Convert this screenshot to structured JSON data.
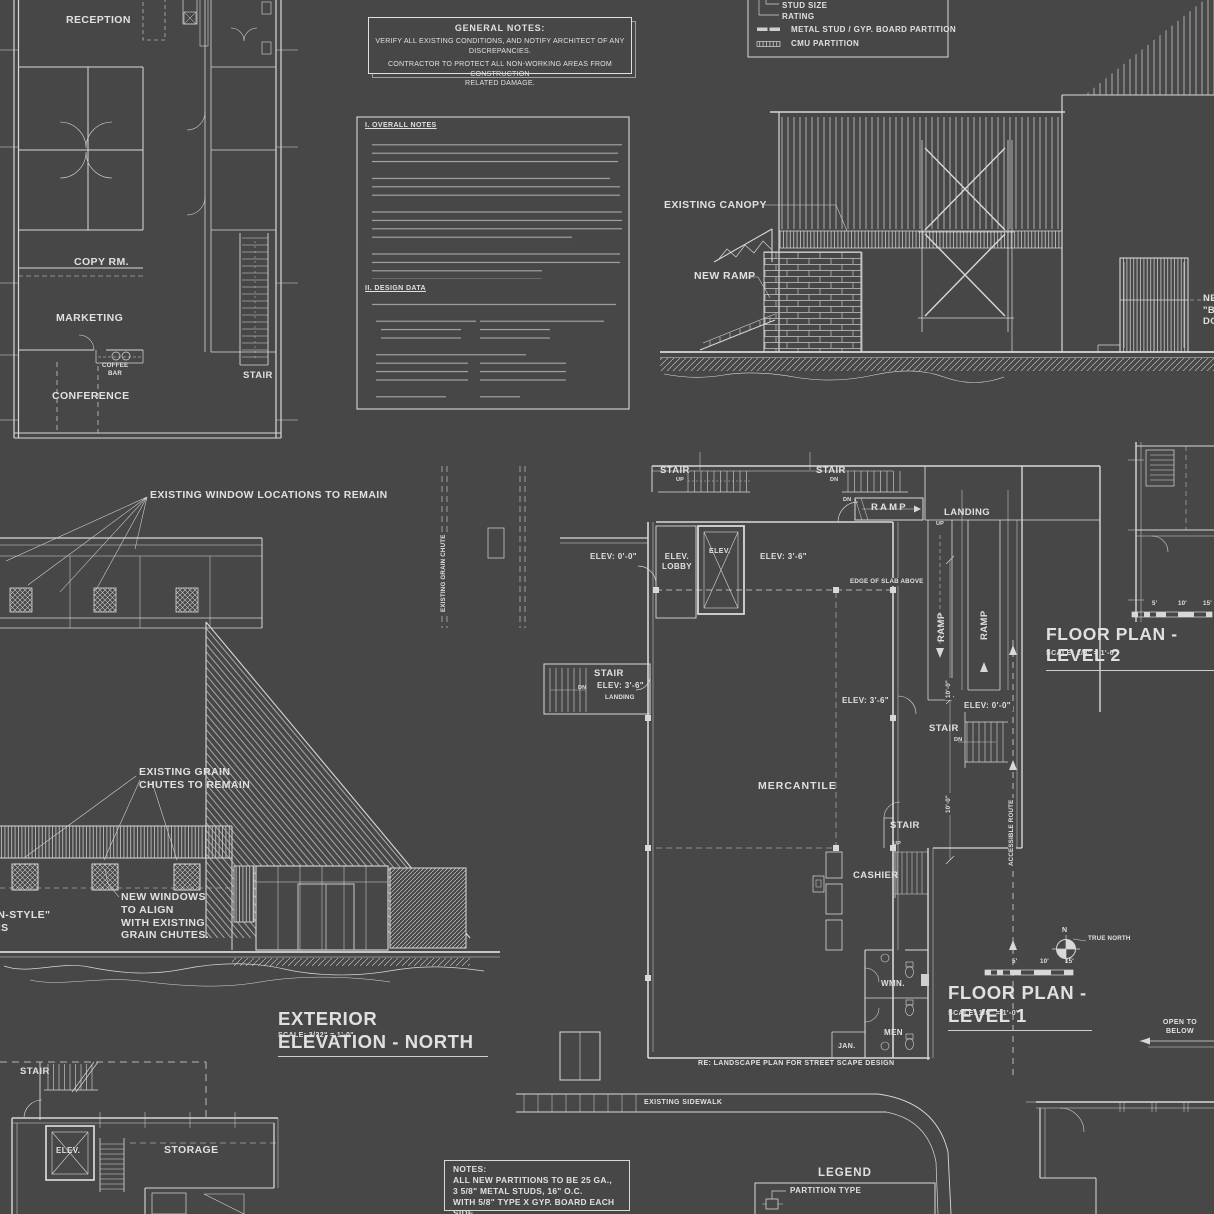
{
  "colors": {
    "background": "#474747",
    "line": "#d8d8d8",
    "text": "#e0e0e0"
  },
  "office_plan": {
    "reception": "RECEPTION",
    "copy_room": "COPY RM.",
    "marketing": "MARKETING",
    "coffee_bar": "COFFEE\nBAR",
    "conference": "CONFERENCE",
    "stair": "STAIR"
  },
  "general_notes": {
    "title": "GENERAL NOTES:",
    "line1": "VERIFY ALL EXISTING CONDITIONS, AND NOTIFY ARCHITECT OF ANY DISCREPANCIES.",
    "line2": "CONTRACTOR TO PROTECT ALL NON-WORKING AREAS FROM CONSTRUCTION\nRELATED DAMAGE."
  },
  "partition_legend": {
    "stud_size": "STUD SIZE",
    "rating": "RATING",
    "metal_stud": "METAL STUD / GYP. BOARD PARTITION",
    "cmu": "CMU PARTITION"
  },
  "overall_notes": {
    "section1": "I. OVERALL NOTES",
    "section2": "II. DESIGN DATA"
  },
  "building_section": {
    "existing_canopy": "EXISTING CANOPY",
    "new_ramp": "NEW RAMP",
    "barn_doors": "NEW\n\"BARN-STYLE\"\nDOORS"
  },
  "north_elevation": {
    "existing_windows": "EXISTING WINDOW LOCATIONS TO REMAIN",
    "grain_chutes": "EXISTING GRAIN\nCHUTES TO REMAIN",
    "barn_doors": "NEW\n\"BARN-STYLE\"\nDOORS",
    "new_windows": "NEW WINDOWS\nTO ALIGN\nWITH EXISTING\nGRAIN CHUTES.",
    "title": "EXTERIOR ELEVATION - NORTH",
    "scale": "SCALE: 3/32\" = 1'-0\""
  },
  "level1_plan": {
    "stair": "STAIR",
    "up": "UP",
    "dn": "DN",
    "ramp": "RAMP",
    "landing": "LANDING",
    "elev_lobby": "ELEV.\nLOBBY",
    "elev": "ELEV.",
    "elev_0": "ELEV: 0'-0\"",
    "elev_36": "ELEV: 3'-6\"",
    "edge_of_slab": "EDGE OF SLAB ABOVE",
    "mercantile": "MERCANTILE",
    "cashier": "CASHIER",
    "wmn": "WMN.",
    "men": "MEN",
    "jan": "JAN.",
    "dim_10": "10'-0\"",
    "accessible_route": "ACCESSIBLE ROUTE",
    "existing_grain_chute": "EXISTING GRAIN CHUTE",
    "re_landscape": "RE: LANDSCAPE PLAN FOR STREET SCAPE DESIGN",
    "existing_sidewalk": "EXISTING SIDEWALK"
  },
  "plan_titles": {
    "level1": "FLOOR PLAN - LEVEL 1",
    "level2": "FLOOR PLAN - LEVEL 2",
    "scale": "SCALE: 1/8\" = 1'-0\"",
    "ticks": [
      "5'",
      "10'",
      "15'"
    ]
  },
  "compass": {
    "n": "N",
    "true_north": "TRUE NORTH"
  },
  "open_to_below": "OPEN TO\nBELOW",
  "basement_plan": {
    "stair": "STAIR",
    "elev": "ELEV.",
    "storage": "STORAGE"
  },
  "partition_notes": {
    "title": "NOTES:",
    "lines": [
      "ALL NEW PARTITIONS TO BE 25 GA.,",
      "3 5/8\" METAL STUDS, 16\" O.C.",
      "WITH 5/8\" TYPE X GYP. BOARD EACH SIDE"
    ]
  },
  "legend_bottom": {
    "title": "LEGEND",
    "partition_type": "PARTITION TYPE"
  }
}
